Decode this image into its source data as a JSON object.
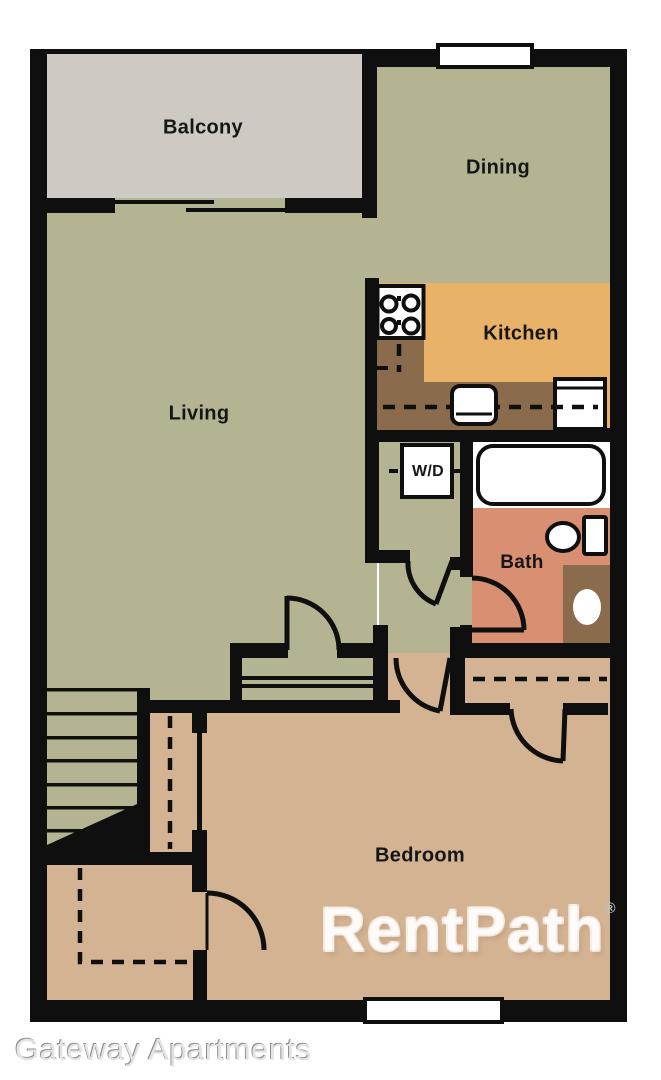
{
  "title": "Gateway Apartments",
  "floor_plan": {
    "rooms": [
      {
        "id": "balcony",
        "label": "Balcony"
      },
      {
        "id": "dining",
        "label": "Dining"
      },
      {
        "id": "kitchen",
        "label": "Kitchen"
      },
      {
        "id": "living",
        "label": "Living"
      },
      {
        "id": "laundry",
        "label": "W/D"
      },
      {
        "id": "bath",
        "label": "Bath"
      },
      {
        "id": "bedroom",
        "label": "Bedroom"
      }
    ],
    "fixtures": [
      {
        "name": "stove-icon",
        "shape": "square with 4 burner circles"
      },
      {
        "name": "kitchen-sink-icon",
        "shape": "rounded rectangle with divider"
      },
      {
        "name": "refrigerator-icon",
        "shape": "bordered rectangle"
      },
      {
        "name": "washer-dryer-icon",
        "shape": "bordered square"
      },
      {
        "name": "bathtub-icon",
        "shape": "rounded rectangle"
      },
      {
        "name": "toilet-icon",
        "shape": "ellipse with tank"
      },
      {
        "name": "vanity-sink-icon",
        "shape": "brown cabinet with oval basin"
      },
      {
        "name": "stairs-icon",
        "shape": "parallel tread lines with diagonal cut"
      },
      {
        "name": "sliding-door-icon",
        "shape": "two offset thin lines"
      },
      {
        "name": "window-icon",
        "shape": "white bar in wall"
      },
      {
        "name": "door-swing-icon",
        "shape": "quarter arc with leaf"
      },
      {
        "name": "closet-rod-icon",
        "shape": "dashed line"
      }
    ],
    "windows_count": 2,
    "colors": {
      "wall": "#0f0f0f",
      "living_green": "#b4b492",
      "balcony_gray": "#cecac3",
      "kitchen_orange": "#e9b269",
      "counter_brown": "#8a6b4b",
      "bath_salmon": "#d98f71",
      "bedroom_tan": "#d4b392",
      "fixture_white": "#ffffff",
      "label_black": "#161616",
      "caption_gray": "#a8a8a8"
    },
    "watermark": {
      "text": "RentPath",
      "symbol": "®"
    },
    "caption": "Gateway Apartments"
  }
}
